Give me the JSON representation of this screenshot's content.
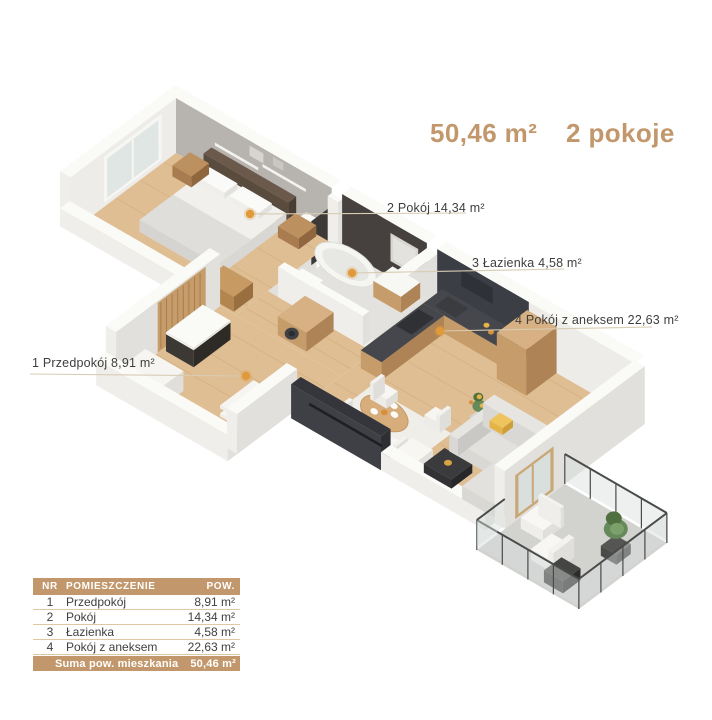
{
  "header": {
    "area": "50,46 m²",
    "rooms": "2 pokoje"
  },
  "labels": [
    {
      "text": "1 Przedpokój 8,91 m²"
    },
    {
      "text": "2 Pokój 14,34 m²"
    },
    {
      "text": "3 Łazienka 4,58 m²"
    },
    {
      "text": "4 Pokój z aneksem 22,63 m²"
    }
  ],
  "table": {
    "headers": [
      "NR",
      "POMIESZCZENIE",
      "POW."
    ],
    "rows": [
      {
        "nr": "1",
        "name": "Przedpokój",
        "area": "8,91 m²"
      },
      {
        "nr": "2",
        "name": "Pokój",
        "area": "14,34 m²"
      },
      {
        "nr": "3",
        "name": "Łazienka",
        "area": "4,58 m²"
      },
      {
        "nr": "4",
        "name": "Pokój z aneksem",
        "area": "22,63 m²"
      }
    ],
    "footer": {
      "label": "Suma pow. mieszkania",
      "value": "50,46 m²"
    }
  },
  "colors": {
    "accent": "#C2976B",
    "dot_orange": "#E09A3C",
    "leader_line": "#D8CCB3",
    "text_dark": "#3F3F3F",
    "table_separator": "#E0C7A4",
    "scene": {
      "wallTop": "#FAFAF7",
      "wallFront": "#EFEEEA",
      "wallSide": "#E1E0DC",
      "wallInner": "#EDECE8",
      "bedWallGray": "#B7B3AF",
      "darkWall": "#46413E",
      "kitchenWall": "#3B3E45",
      "woodFloor": "#DFBE93",
      "woodLine": "#C49D6C",
      "bathFloor": "#E3E2DF",
      "balconyFloor": "#D2D2CF",
      "wood": "#C59C6A",
      "woodTop": "#D7B183",
      "woodDark": "#AE8355",
      "counterTop": "#45474C",
      "darkFurn": "#39352F",
      "nearlyBlack": "#303136",
      "white1": "#F4F3F0",
      "white2": "#EAE9E5",
      "gray1": "#DCDBD7",
      "sofa": "#D9D8D5",
      "sofaSide": "#C9C8C4",
      "rugLight": "#F0EEE9",
      "glass": "#D7DEDB",
      "rail": "#484B4A",
      "green": "#66895A",
      "greenDark": "#50713F",
      "greenLight": "#7BA06B",
      "yellow": "#E5B448",
      "tub": "#F5F5F2",
      "tubInner": "#E7E7E3"
    }
  }
}
